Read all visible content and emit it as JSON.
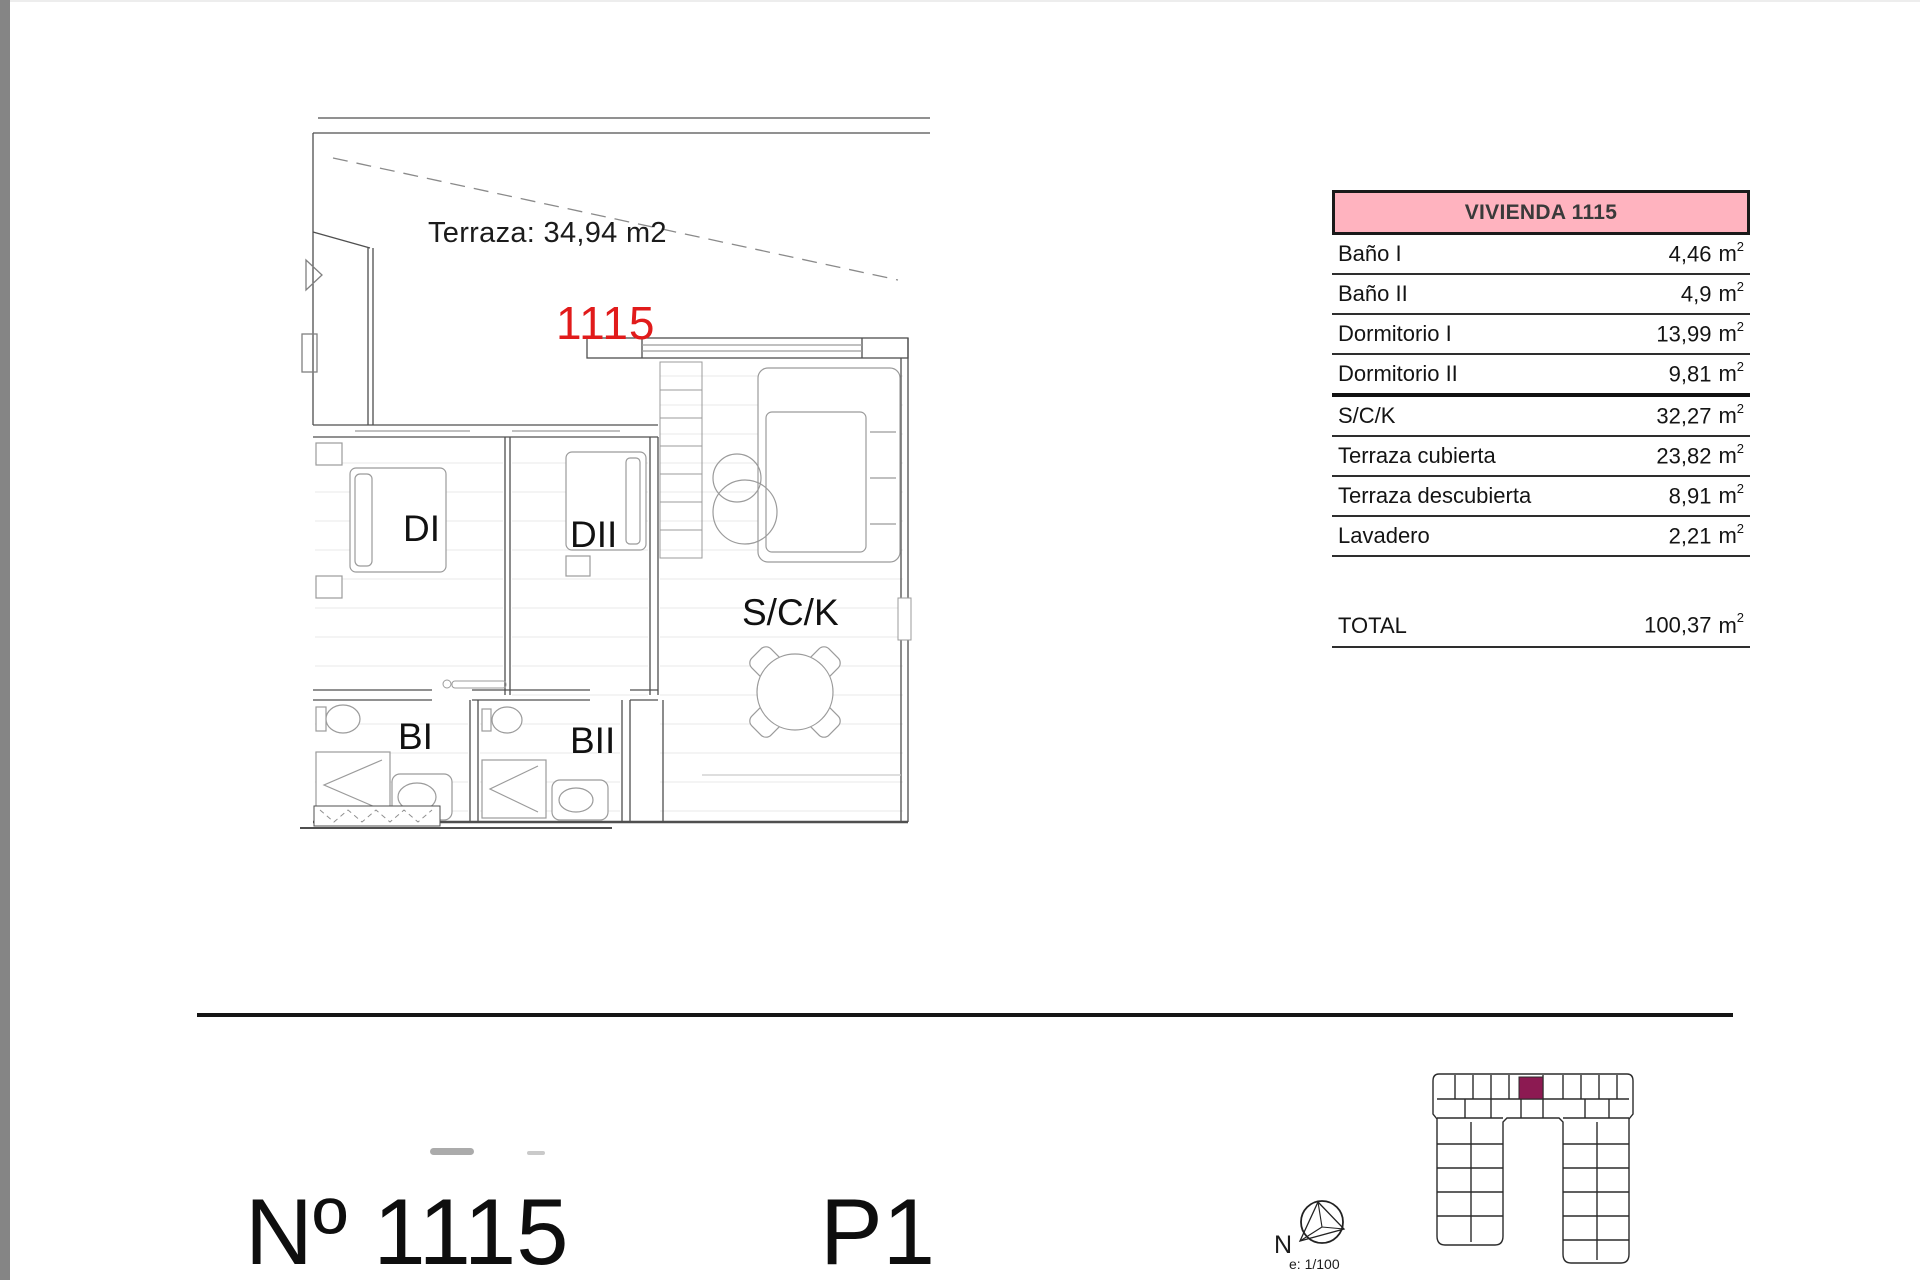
{
  "document": {
    "type": "apartment floor plan sheet",
    "accent_red": "#E11B1B",
    "table_header_pink": "#FFB3BF",
    "site_highlight_color": "#8C1A52"
  },
  "floor_plan": {
    "terrace_label": "Terraza: 34,94 m2",
    "unit_number": "1115",
    "rooms": {
      "dormitorio1": "DI",
      "dormitorio2": "DII",
      "salon": "S/C/K",
      "bano1": "BI",
      "bano2": "BII"
    }
  },
  "area_table": {
    "title": "VIVIENDA 1115",
    "unit_base": "m",
    "unit_sup": "2",
    "rows": [
      {
        "label": "Baño I",
        "value": "4,46"
      },
      {
        "label": "Baño II",
        "value": "4,9"
      },
      {
        "label": "Dormitorio I",
        "value": "13,99"
      },
      {
        "label": "Dormitorio II",
        "value": "9,81"
      },
      {
        "label": "S/C/K",
        "value": "32,27"
      },
      {
        "label": "Terraza cubierta",
        "value": "23,82"
      },
      {
        "label": "Terraza descubierta",
        "value": "8,91"
      },
      {
        "label": "Lavadero",
        "value": "2,21"
      }
    ],
    "total": {
      "label": "TOTAL",
      "value": "100,37"
    }
  },
  "footer": {
    "unit_label": "Nº 1115",
    "floor_label": "P1",
    "compass_letter": "N",
    "scale_note": "e: 1/100"
  }
}
